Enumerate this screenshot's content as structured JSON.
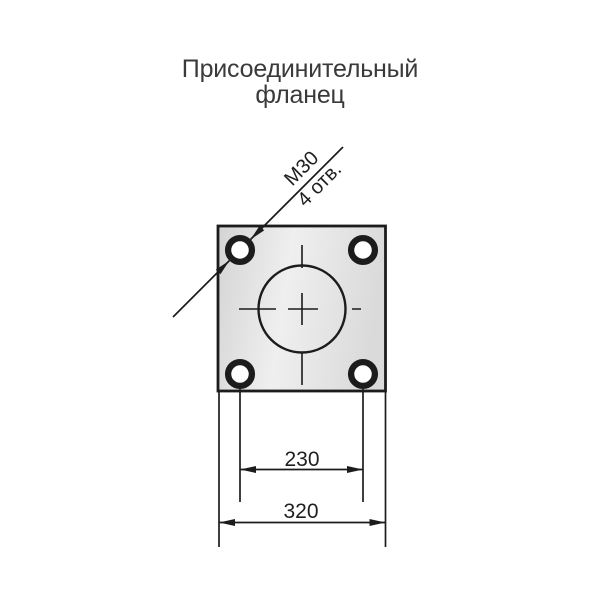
{
  "title": {
    "line1": "Присоединительный",
    "line2": "фланец"
  },
  "callout": {
    "thread": "М30",
    "holes": "4 отв."
  },
  "dimensions": {
    "bolt_spacing": "230",
    "flange_width": "320"
  },
  "colors": {
    "line": "#1c1c1c",
    "title_text": "#3a3a3a",
    "dim_text": "#1f1f1f",
    "plate_dark": "#d4d4d4",
    "plate_light": "#efefef",
    "plate_mid": "#dadada",
    "hole_fill": "#ffffff",
    "background": "#ffffff"
  }
}
